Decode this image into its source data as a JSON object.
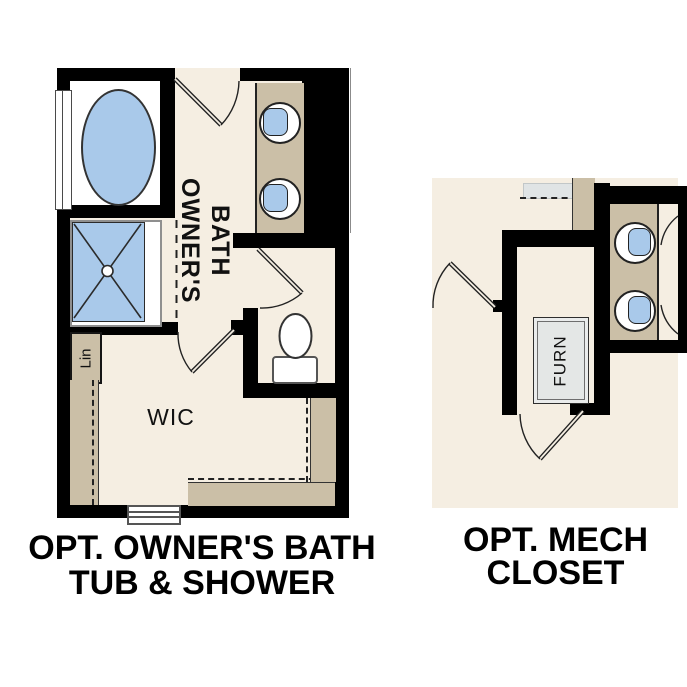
{
  "left_plan": {
    "caption": [
      "OPT. OWNER'S BATH",
      "TUB & SHOWER"
    ],
    "labels": {
      "bath_col1": "OWNER'S",
      "bath_col2": "BATH",
      "wic": "WIC",
      "linen": "Lin"
    }
  },
  "right_plan": {
    "caption": [
      "OPT. MECH",
      "CLOSET"
    ],
    "labels": {
      "furnace": "FURN"
    }
  },
  "colors": {
    "wall": "#000000",
    "floor": "#f5eee2",
    "cabinet_tan": "#cbbfa7",
    "fixture_blue": "#a9c9ea",
    "fixture_outline": "#222222",
    "shelf_gray": "#e0e4e5",
    "furnace_fill": "#e4e7e6",
    "text": "#000000"
  }
}
